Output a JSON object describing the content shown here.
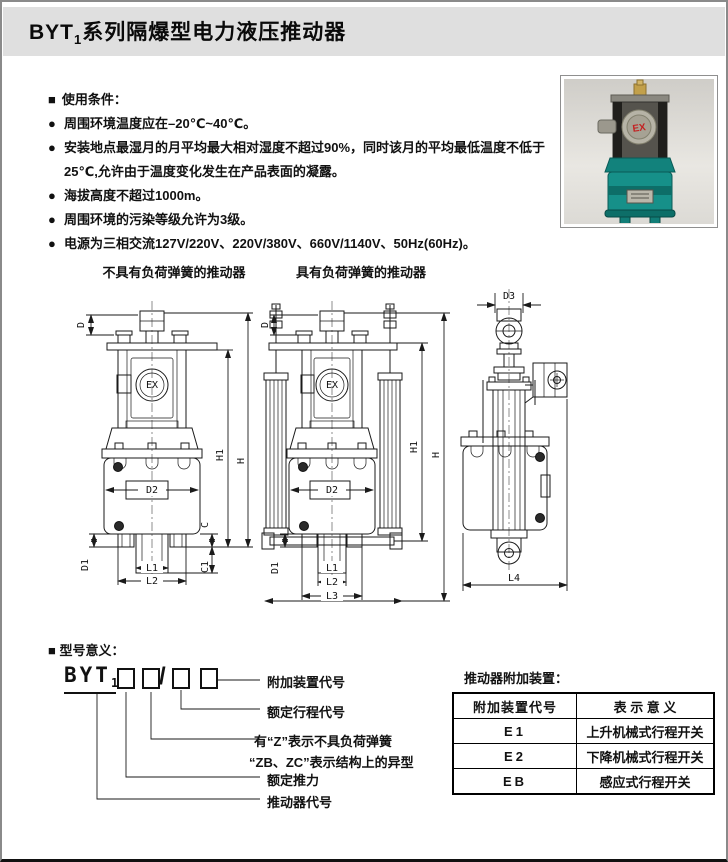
{
  "title": {
    "prefix": "BYT",
    "sub": "1",
    "rest": "系列隔爆型电力液压推动器"
  },
  "conditions": {
    "marker": "■",
    "heading": "使用条件：",
    "bullet": "●",
    "items": [
      "周围环境温度应在–20℃~40℃。",
      "安装地点最湿月的月平均最大相对湿度不超过90%，同时该月的平均最低温度不低于25℃,允许由于温度变化发生在产品表面的凝露。",
      "海拔高度不超过1000m。",
      "周围环境的污染等级允许为3级。",
      "电源为三相交流127V/220V、220V/380V、660V/1140V、50Hz(60Hz)。"
    ]
  },
  "photo": {
    "ex_label": "EX"
  },
  "diagrams": {
    "caption_left": "不具有负荷弹簧的推动器",
    "caption_right": "具有负荷弹簧的推动器",
    "ex_label": "EX",
    "dims": {
      "d": "D",
      "h1": "H1",
      "h": "H",
      "d2": "D2",
      "c": "C",
      "c1": "C1",
      "d1": "D1",
      "l1": "L1",
      "l2": "L2",
      "l3": "L3",
      "d3": "D3",
      "l4": "L4"
    }
  },
  "model": {
    "marker": "■",
    "heading": "型号意义：",
    "code_prefix": "BYT",
    "code_sub": "1",
    "slash": "/",
    "labels": {
      "accessory": "附加装置代号",
      "stroke": "额定行程代号",
      "z_note": "有“Z”表示不具负荷弹簧",
      "zbzc_note": "“ZB、ZC”表示结构上的异型",
      "thrust": "额定推力",
      "code": "推动器代号"
    }
  },
  "accessories_table": {
    "caption": "推动器附加装置：",
    "headers": [
      "附加装置代号",
      "表 示 意 义"
    ],
    "rows": [
      [
        "E1",
        "上升机械式行程开关"
      ],
      [
        "E2",
        "下降机械式行程开关"
      ],
      [
        "EB",
        "感应式行程开关"
      ]
    ]
  }
}
